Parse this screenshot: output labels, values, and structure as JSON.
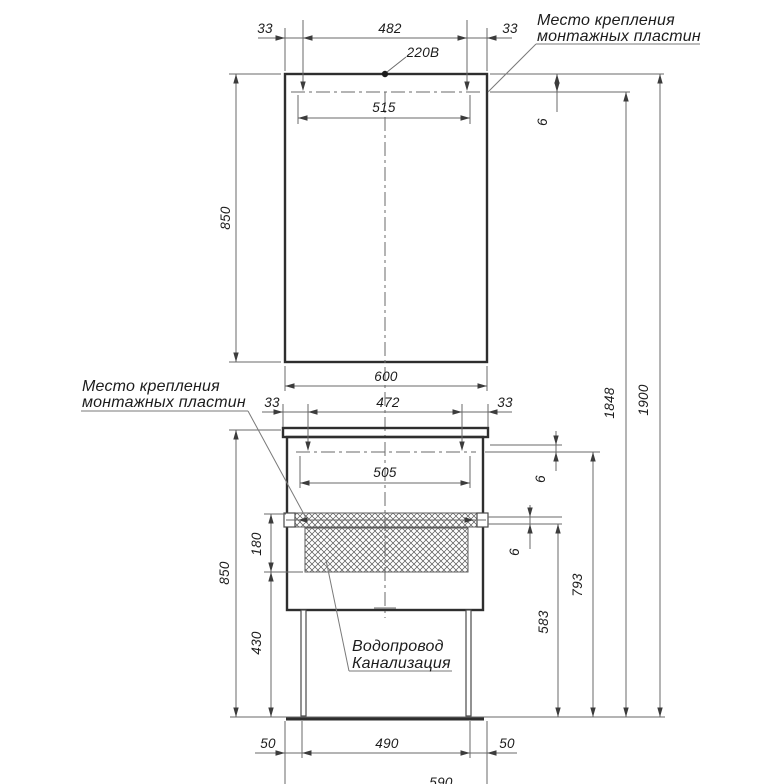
{
  "notes": {
    "mounting_top_l1": "Место крепления",
    "mounting_top_l2": "монтажных пластин",
    "mounting_left_l1": "Место крепления",
    "mounting_left_l2": "монтажных пластин",
    "power": "220В",
    "plumbing_l1": "Водопровод",
    "plumbing_l2": "Канализация"
  },
  "dims": {
    "mirror_margin_left": "33",
    "mirror_plate_span": "482",
    "mirror_margin_right": "33",
    "mirror_rail_length": "515",
    "mirror_height": "850",
    "overall_width": "600",
    "mirror_rail_offset": "6",
    "rail_height": "1848",
    "total_height": "1900",
    "cab_margin_left": "33",
    "cab_plate_span": "472",
    "cab_margin_right": "33",
    "cab_rail_length": "505",
    "cab_rail_offset": "6",
    "plate_thickness": "6",
    "service_zone": "180",
    "zone_floor": "430",
    "plate_floor": "583",
    "rail_floor": "793",
    "cab_height": "850",
    "leg_left": "50",
    "leg_span": "490",
    "leg_right": "50",
    "body_width": "590"
  }
}
